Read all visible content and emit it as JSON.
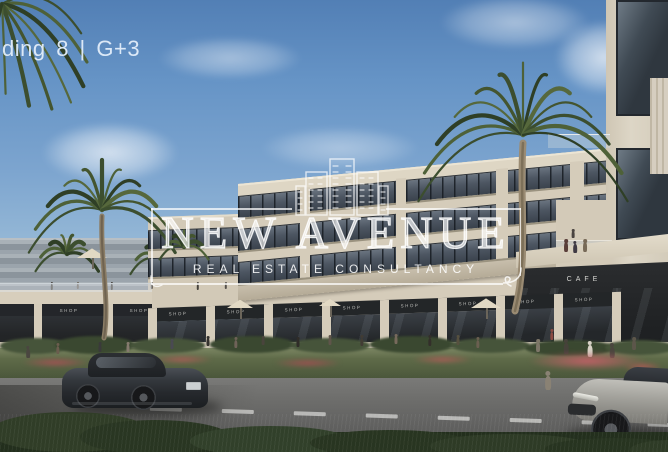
{
  "overlay": {
    "building_label": "ding 8 | G+3"
  },
  "watermark": {
    "brand": "NEW AVENUE",
    "tagline": "REAL ESTATE CONSULTANCY",
    "logo_icon": "buildings-skyline-icon"
  },
  "signs": {
    "cafe": "CAFE",
    "shops": [
      "SHOP",
      "SHOP",
      "SHOP",
      "SHOP",
      "SHOP",
      "SHOP",
      "SHOP",
      "SHOP",
      "SHOP",
      "SHOP"
    ]
  },
  "colors": {
    "sky_top": "#527fb5",
    "sky_horizon": "#ccd8df",
    "facade_cream": "#d5ccba",
    "glass_dark": "#3c444e",
    "storefront_dark": "#26282a",
    "hedge_green": "#2c3a26",
    "road_gray": "#6e6e6c",
    "watermark_white": "rgba(255,255,255,0.8)"
  }
}
